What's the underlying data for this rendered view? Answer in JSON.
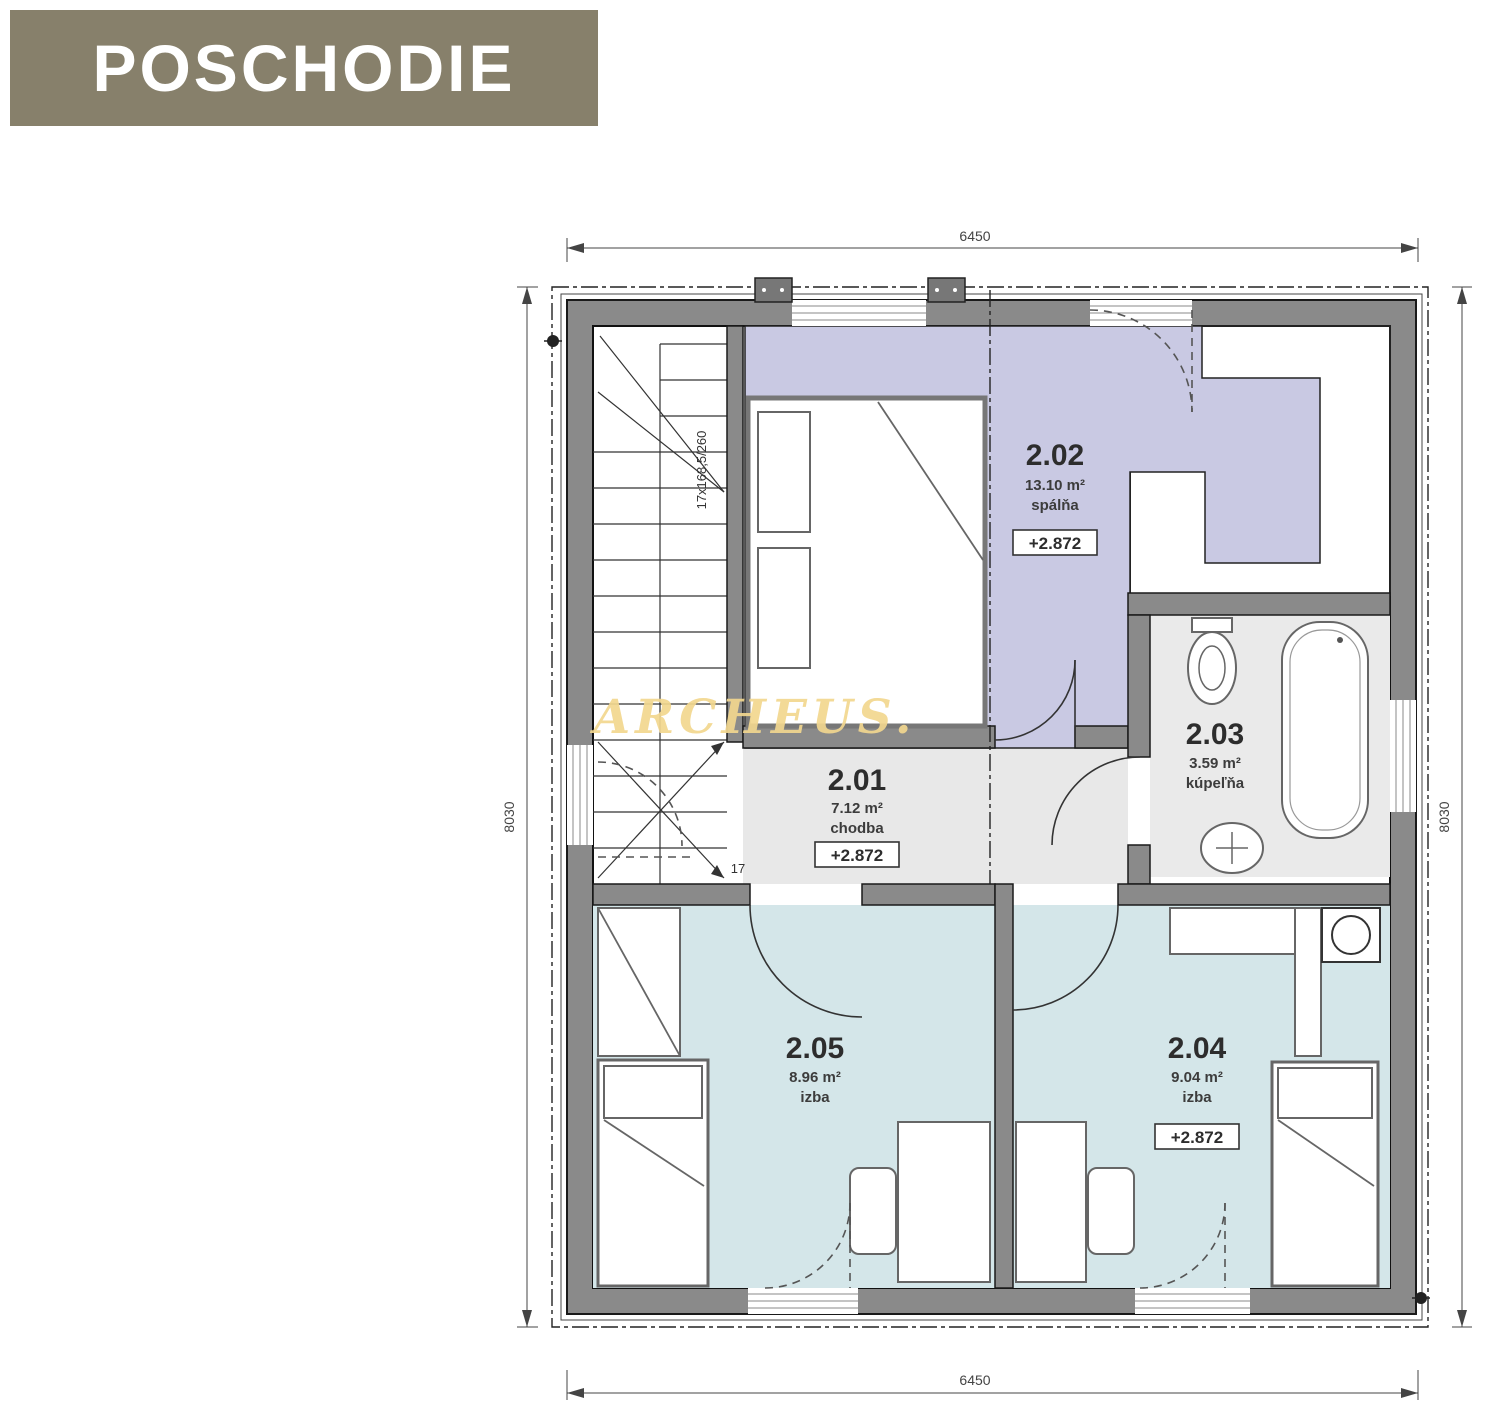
{
  "title": "POSCHODIE",
  "watermark": "ARCHEUS.",
  "plan": {
    "dimensions": {
      "top": "6450",
      "bottom": "6450",
      "left": "8030",
      "right": "8030"
    },
    "stairs": {
      "label": "17x168,5/260",
      "last_step": "17"
    },
    "rooms": [
      {
        "number": "2.01",
        "area": "7.12 m²",
        "name": "chodba",
        "elevation": "+2.872"
      },
      {
        "number": "2.02",
        "area": "13.10 m²",
        "name": "spálňa",
        "elevation": "+2.872"
      },
      {
        "number": "2.03",
        "area": "3.59 m²",
        "name": "kúpeľňa",
        "elevation": null
      },
      {
        "number": "2.04",
        "area": "9.04 m²",
        "name": "izba",
        "elevation": "+2.872"
      },
      {
        "number": "2.05",
        "area": "8.96 m²",
        "name": "izba",
        "elevation": null
      }
    ],
    "colors": {
      "title_bg": "#87806b",
      "wall": "#8a8a8a",
      "bedroom_fill": "#c9c9e3",
      "room_fill": "#d4e6e9",
      "corridor_fill": "#e8e8e8",
      "bathroom_fill": "#eaeaea",
      "watermark": "#f2d78f"
    }
  }
}
